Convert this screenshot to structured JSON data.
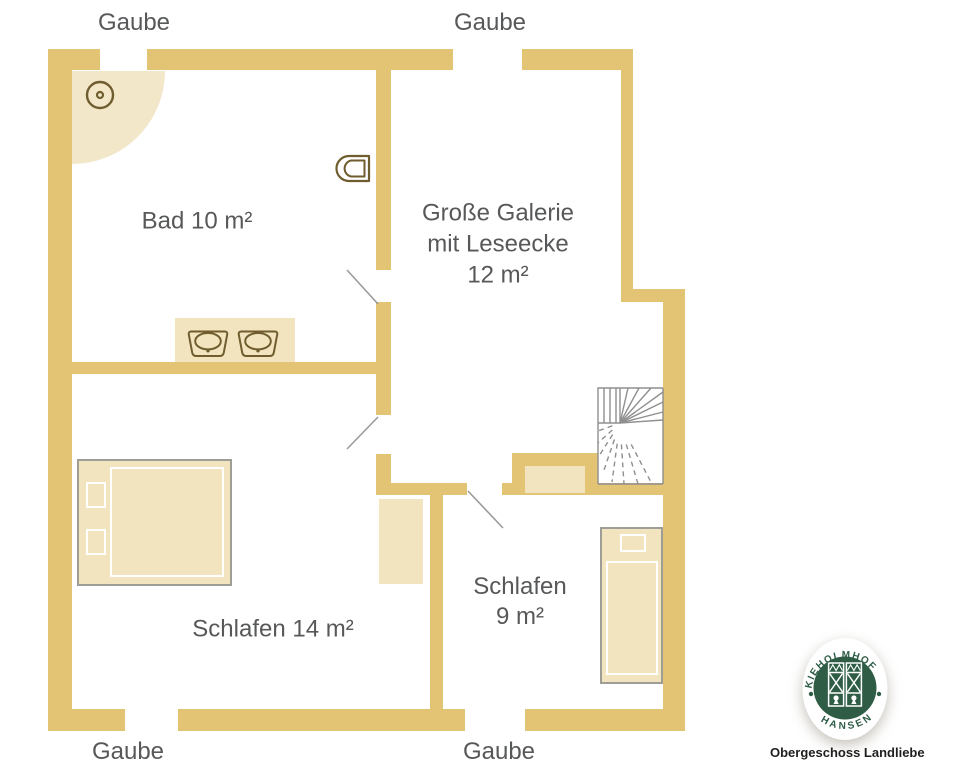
{
  "plan": {
    "type": "floor-plan",
    "colors": {
      "wall_gold": "#E3C374",
      "light_tan": "#F2E4BE",
      "fixture_brown": "#705D2F",
      "door_line_gray": "#9B9B9B",
      "stair_gray": "#8F8F8F",
      "label_gray": "#57585A",
      "logo_green": "#2E5C45"
    },
    "gaube_labels": {
      "top_left": "Gaube",
      "top_middle": "Gaube",
      "bottom_left": "Gaube",
      "bottom_middle": "Gaube"
    },
    "rooms": {
      "bad": {
        "label": "Bad 10 m²",
        "area_m2": 10
      },
      "galerie": {
        "line1": "Große Galerie",
        "line2": "mit Leseecke",
        "line3": "12 m²",
        "area_m2": 12
      },
      "schlafen14": {
        "label": "Schlafen 14 m²",
        "area_m2": 14
      },
      "schlafen9": {
        "line1": "Schlafen",
        "line2": "9 m²",
        "area_m2": 9
      }
    },
    "fixtures": [
      "shower-corner",
      "floor-drain",
      "toilet",
      "double-washbasin",
      "double-bed",
      "single-bed",
      "wardrobe",
      "staircase"
    ]
  },
  "logo": {
    "arc_top": "KIEHOLMHOF",
    "arc_bottom": "HANSEN",
    "caption": "Obergeschoss Landliebe"
  }
}
